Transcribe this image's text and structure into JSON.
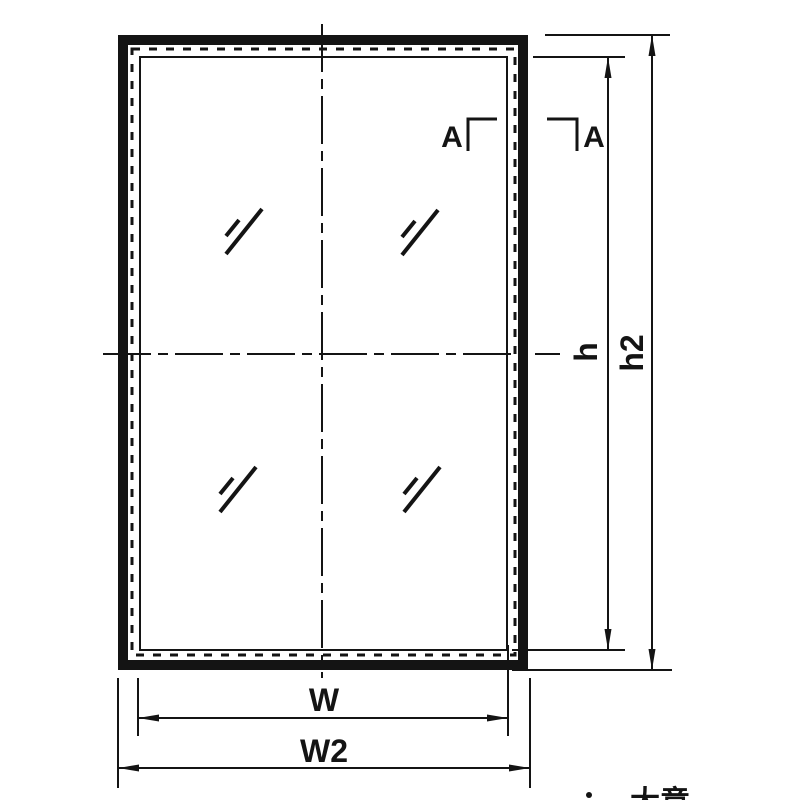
{
  "drawing": {
    "type": "technical-elevation-drawing",
    "labels": {
      "section_left": "A",
      "section_right": "A",
      "height_inner": "h",
      "height_outer": "h2",
      "width_inner": "W",
      "width_outer": "W2",
      "corner_fragment": "大意"
    },
    "colors": {
      "line": "#141414",
      "background": "#ffffff"
    }
  }
}
